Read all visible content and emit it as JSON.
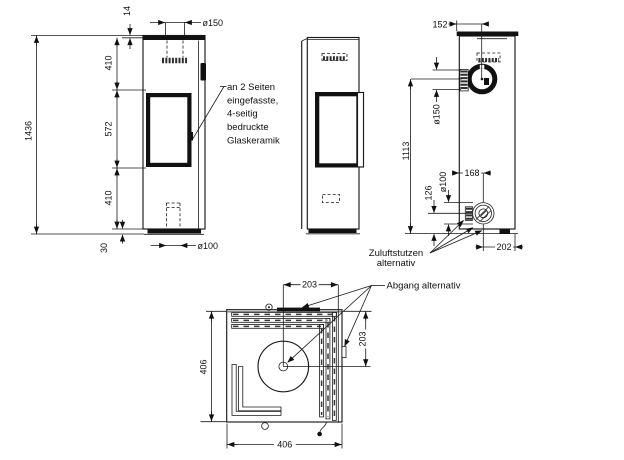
{
  "drawing": {
    "front": {
      "plate_thickness": "14",
      "flue_diameter": "ø150",
      "upper_section": "410",
      "glass_section": "572",
      "lower_section": "410",
      "total_height": "1436",
      "base_height": "30",
      "inlet_diameter": "ø100"
    },
    "back": {
      "flue_offset": "152",
      "flue_diameter": "ø150",
      "flue_height": "1113",
      "inlet_height": "126",
      "inlet_diameter": "ø100",
      "inlet_offset": "168",
      "inlet_side_offset": "202"
    },
    "top": {
      "outlet_from_center_x": "203",
      "outlet_from_center_y": "203",
      "width": "406",
      "depth": "406"
    },
    "notes": {
      "glass": [
        "an 2 Seiten",
        "eingefasste,",
        "4-seitig",
        "bedruckte",
        "Glaskeramik"
      ],
      "air_inlet": [
        "Zuluftstutzen",
        "alternativ"
      ],
      "flue_alt": "Abgang alternativ"
    },
    "colors": {
      "line": "#1a1a1a",
      "ink": "#111111",
      "background": "#ffffff"
    }
  }
}
